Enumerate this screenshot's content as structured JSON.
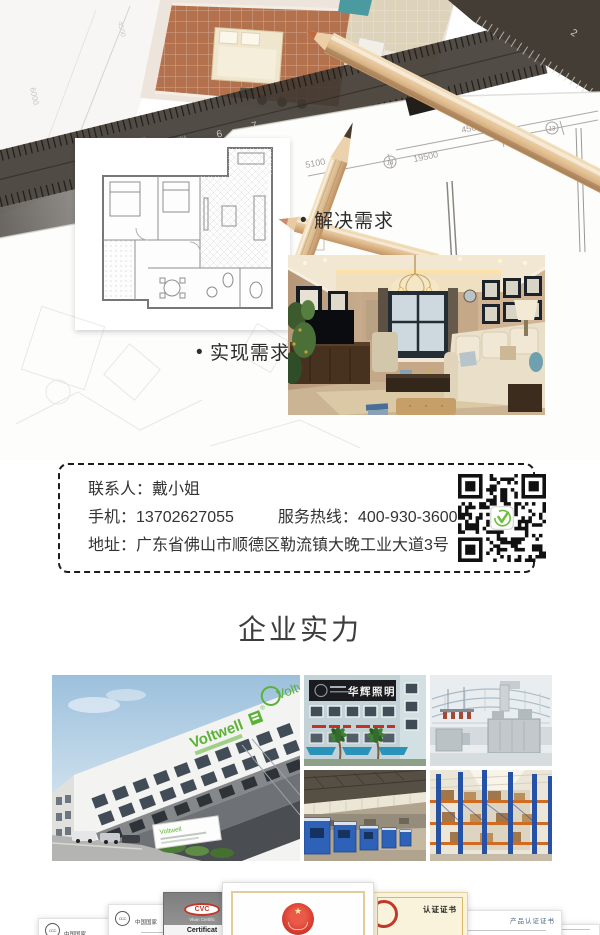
{
  "hero": {
    "bullet_marker": "•",
    "bullets": [
      {
        "label": "解决需求"
      },
      {
        "label": "实现需求"
      }
    ],
    "dims": {
      "d5100": "5100",
      "d4500": "4500",
      "d19500": "19500",
      "axis_left": "14",
      "axis_right": "13",
      "faint_v": "6000",
      "faint_h": "4500"
    },
    "ruler": {
      "n5": "5",
      "n6": "6",
      "n7": "7",
      "n2": "2",
      "brand": "STAINLESS",
      "origin": "MADE IN CHINA"
    }
  },
  "contact": {
    "line1_label": "联系人：",
    "line1_value": "戴小姐",
    "phone_label": "手机：",
    "phone_value": "13702627055",
    "hotline_label": "服务热线：",
    "hotline_value": "400-930-3600",
    "address_label": "地址：",
    "address_value": "广东省佛山市顺德区勒流镇大晚工业大道3号"
  },
  "strength": {
    "title": "企业实力"
  },
  "gallery": {
    "voltwell_logo": "Voltwell",
    "voltwell_reg": "®",
    "huahui_sign": "华辉照明"
  },
  "certs": {
    "ccc_text": "中国国家",
    "cvc": "CVC",
    "vkan": "Vkan Certific",
    "cert_en": "Certificat",
    "cn_book": "认证证书",
    "cn_product": "产品认证证书"
  },
  "colors": {
    "accent_green": "#6cbf3c",
    "text_dark": "#333333"
  }
}
